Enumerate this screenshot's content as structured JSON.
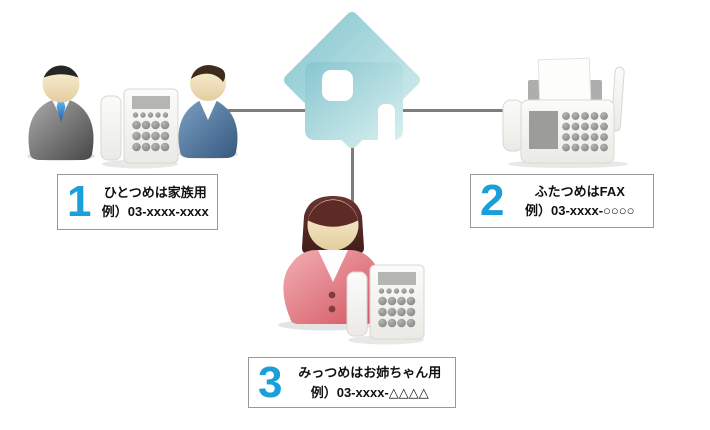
{
  "canvas": {
    "width": 710,
    "height": 430,
    "background": "#ffffff"
  },
  "palette": {
    "accent_number": "#1b9fd8",
    "connector_line": "#7d7d7d",
    "box_border": "#999999",
    "house_teal_dark": "#86c6cf",
    "house_teal_light": "#d8efef",
    "suit_gray": "#5a5a5a",
    "sweater_blue": "#41658f",
    "cardigan_pink": "#e37f89",
    "tie_blue": "#2a6cb5"
  },
  "icons": {
    "house": "house-icon",
    "father": "father-person-icon",
    "son": "son-person-icon",
    "daughter": "daughter-person-icon",
    "family_phone": "telephone-icon",
    "daughter_phone": "telephone-icon",
    "fax": "fax-machine-icon"
  },
  "labels": [
    {
      "number": "1",
      "line1": "ひとつめは家族用",
      "line2": "例）03-xxxx-xxxx"
    },
    {
      "number": "2",
      "line1": "ふたつめはFAX",
      "line2": "例）03-xxxx-○○○○"
    },
    {
      "number": "3",
      "line1": "みっつめはお姉ちゃん用",
      "line2": "例）03-xxxx-△△△△"
    }
  ]
}
